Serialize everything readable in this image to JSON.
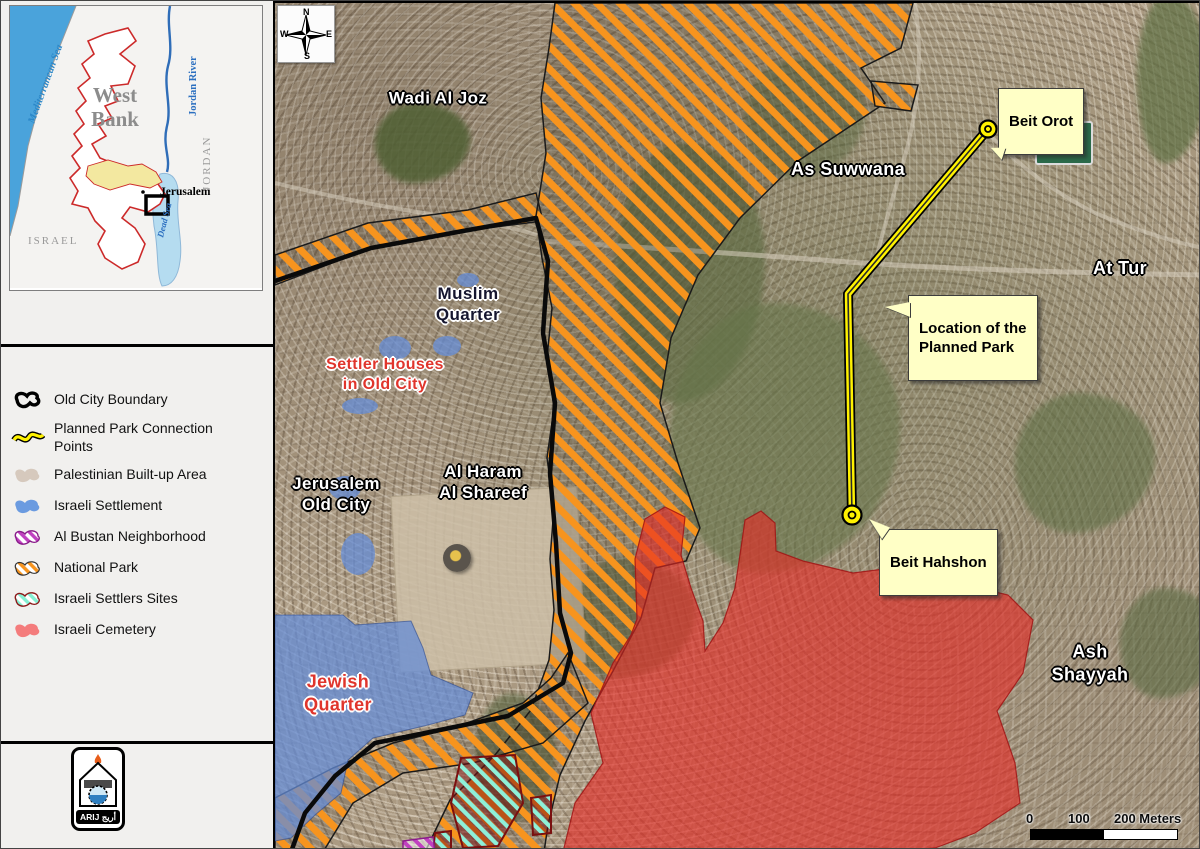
{
  "inset": {
    "west_bank": "West\nBank",
    "mediterranean": "Mediterranean Sea",
    "jordan_river": "Jordan River",
    "jordan": "JORDAN",
    "israel": "ISRAEL",
    "jerusalem": "Jerusalem",
    "dead_sea": "Dead Sea"
  },
  "legend": {
    "items": [
      {
        "label": "Old City Boundary",
        "icon": "old-city-boundary",
        "swatch": "#000000"
      },
      {
        "label": "Planned Park Connection Points",
        "icon": "planned-park-connection-points",
        "swatch": "#FFF200"
      },
      {
        "label": "Palestinian Built-up Area",
        "icon": "palestinian-built-up-area",
        "swatch": "#D6C9BD"
      },
      {
        "label": "Israeli Settlement",
        "icon": "israeli-settlement",
        "swatch": "#6B9BE0"
      },
      {
        "label": "Al Bustan Neighborhood",
        "icon": "al-bustan-neighborhood",
        "swatch": "#AA22AA"
      },
      {
        "label": "National Park",
        "icon": "national-park",
        "swatch": "#F7941E"
      },
      {
        "label": "Israeli Settlers Sites",
        "icon": "israeli-settlers-sites",
        "swatch": "#85EFD2"
      },
      {
        "label": "Israeli Cemetery",
        "icon": "israeli-cemetery",
        "swatch": "#F47C7C"
      }
    ]
  },
  "logo": {
    "text": "ARIJ أريج"
  },
  "compass": {
    "n": "N",
    "e": "E",
    "s": "S",
    "w": "W"
  },
  "map": {
    "place_labels": [
      {
        "text": "Wadi Al Joz"
      },
      {
        "text": "As Suwwana"
      },
      {
        "text": "At Tur"
      },
      {
        "text": "Ash Shayyah"
      },
      {
        "text": "Muslim\nQuarter"
      },
      {
        "text": "Settler Houses\nin Old City"
      },
      {
        "text": "Jerusalem\nOld City"
      },
      {
        "text": "Al Haram\nAl Shareef"
      },
      {
        "text": "Jewish\nQuarter"
      }
    ],
    "callouts": [
      {
        "label": "Beit Orot"
      },
      {
        "label": "Location of the\nPlanned Park"
      },
      {
        "label": "Beit Hahshon"
      }
    ],
    "scale": {
      "tick0": "0",
      "tick1": "100",
      "tick2": "200 Meters"
    }
  },
  "colors": {
    "national_park_orange": "#F7941E",
    "settlement_blue": "#6B9BE0",
    "cemetery_red": "#E8392F",
    "settlers_teal": "#8EF0D8",
    "al_bustan_purple": "#C040C0",
    "park_line_yellow": "#FFF200",
    "built_up_beige": "#D6C9BD",
    "callout_bg": "#FFFFC6"
  }
}
